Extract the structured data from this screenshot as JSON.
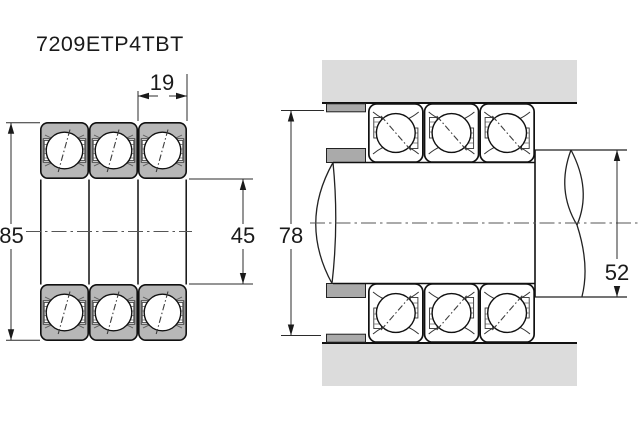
{
  "page": {
    "title": "7209ETP4TBT"
  },
  "left_view": {
    "description": "Triplex bearing set cross-section",
    "dim_width": "19",
    "dim_outer_diameter": "85",
    "dim_bore_diameter": "45"
  },
  "right_view": {
    "description": "Mounted arrangement in housing on shaft",
    "dim_housing_abutment_diameter": "78",
    "dim_shaft_shoulder_diameter": "52"
  },
  "colors": {
    "background": "#ffffff",
    "line": "#111111",
    "dimension_line": "#2b2b2b",
    "ring_fill": "#b7b7b7",
    "housing_fill": "#dcdcdc",
    "spacer_fill": "#aaaaaa",
    "text": "#1a1a1a"
  }
}
